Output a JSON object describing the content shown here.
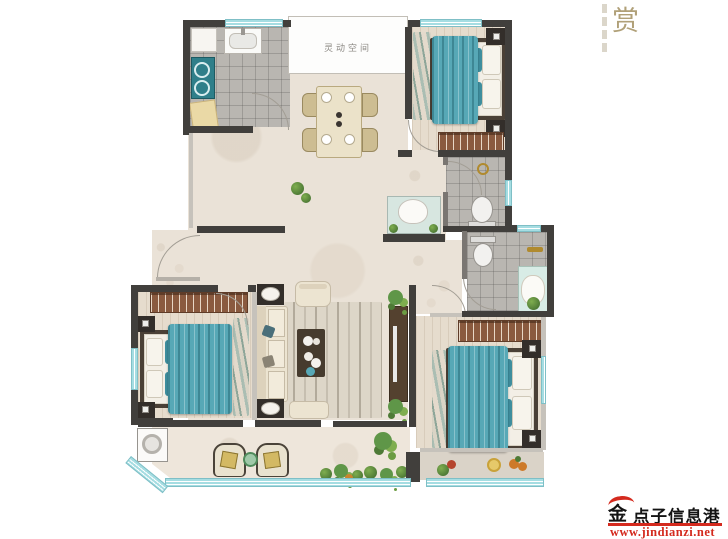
{
  "header": {
    "title_char": "赏"
  },
  "rooms": {
    "flex_space_label": "灵动空间"
  },
  "watermark": {
    "logo_char": "金",
    "brand": "点子信息港",
    "url": "www.jindianzi.net"
  },
  "colors": {
    "wall": "#413f3c",
    "window": "#a5dde2",
    "bed": "#57a8b6",
    "wardrobe": "#8a5a3f",
    "floor": "#eae2d7",
    "tile": "#b9b6b1",
    "wood": "#e6dccd",
    "red": "#d42a1e",
    "gold": "#b08a2e",
    "title": "#b0a078"
  }
}
